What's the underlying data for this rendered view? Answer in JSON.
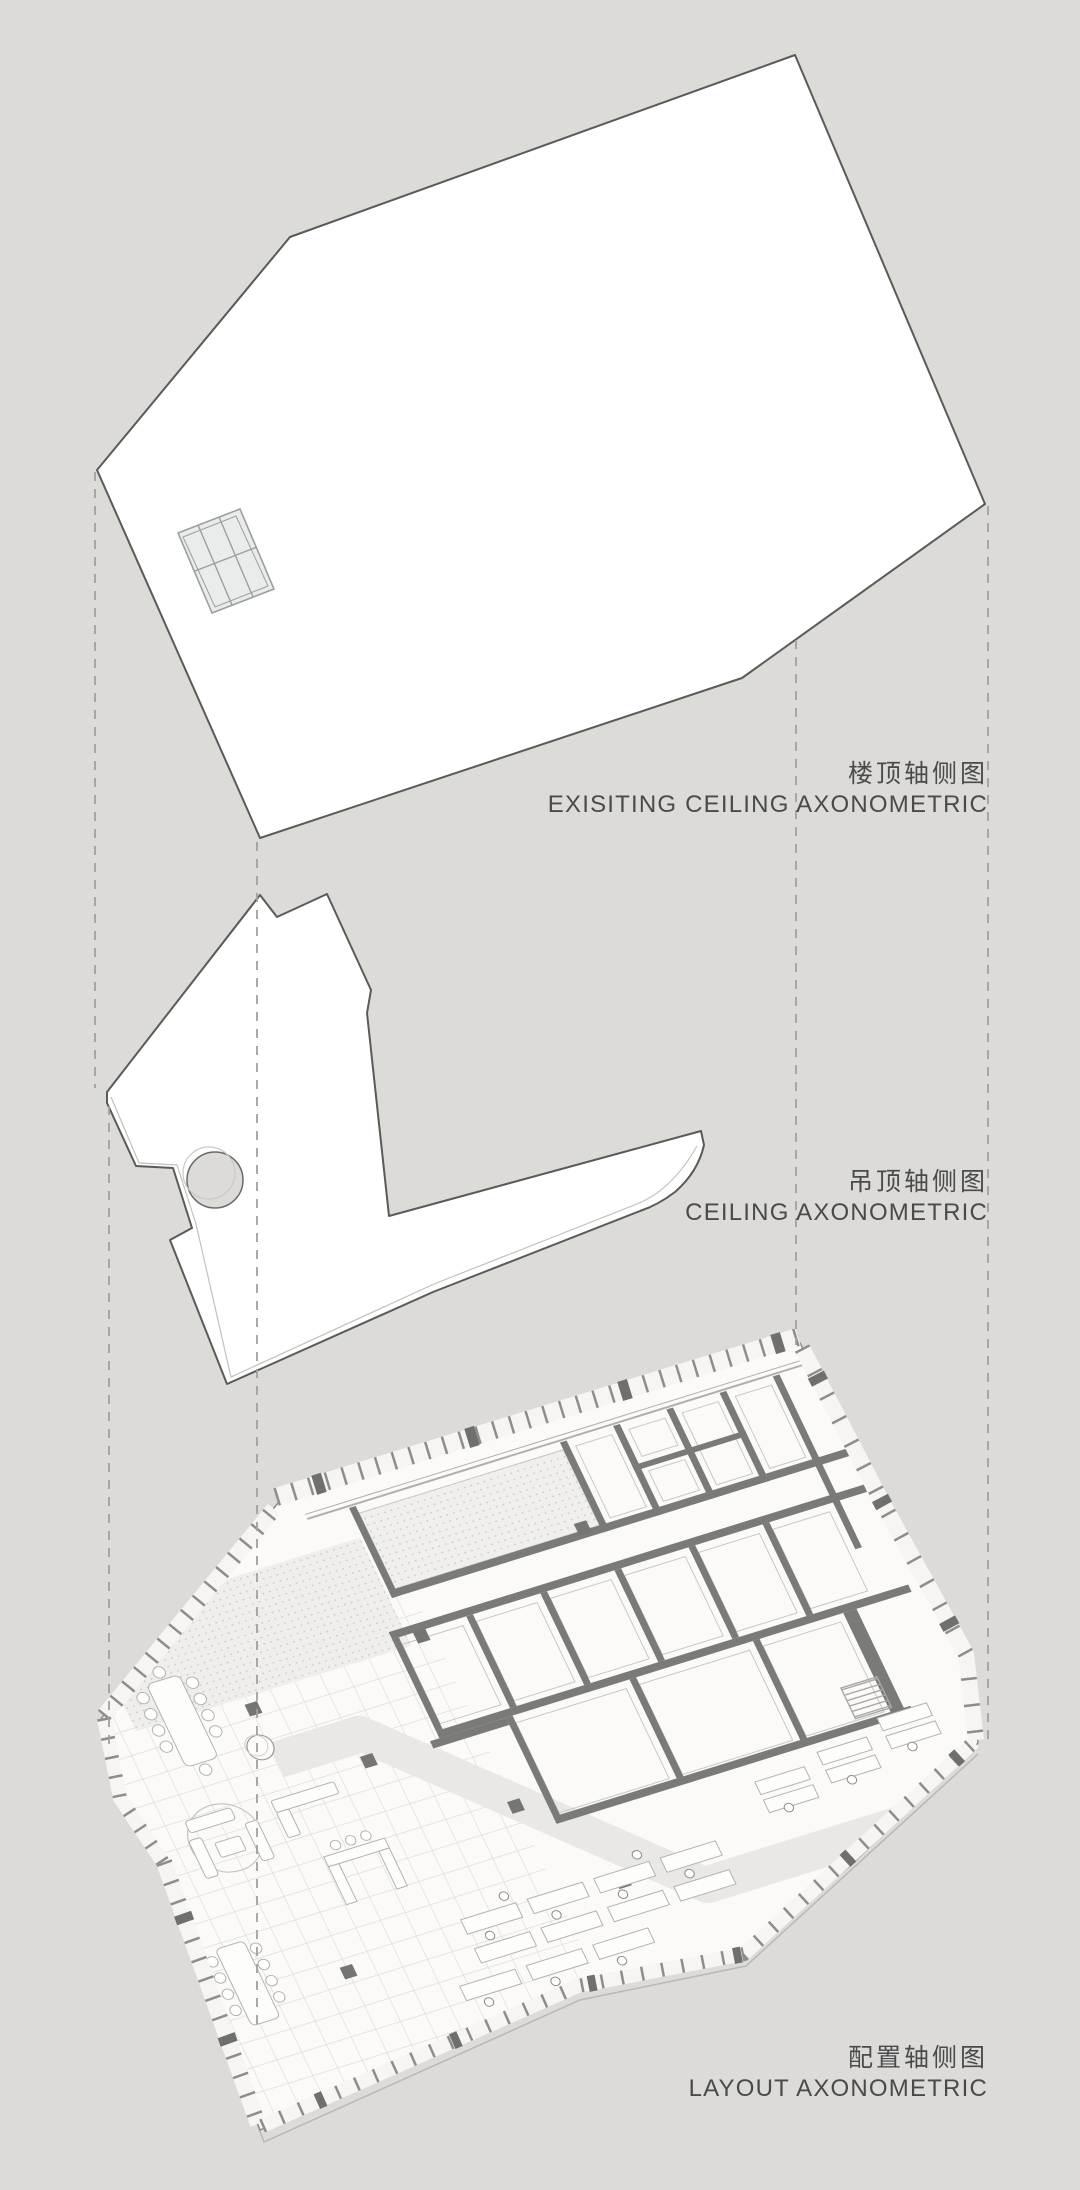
{
  "scene": {
    "background_color": "#dcdbd7",
    "line_color": "#5a5a58",
    "wall_color": "#7a7a78",
    "text_color": "#4a4a4c",
    "guide_color": "#a0a09c",
    "description": "Exploded axonometric diagram with three stacked levels connected by dashed projection lines"
  },
  "views": [
    {
      "id": "existing-ceiling",
      "title_zh": "楼顶轴侧图",
      "title_en": "EXISITING CEILING AXONOMETRIC"
    },
    {
      "id": "ceiling",
      "title_zh": "吊顶轴侧图",
      "title_en": "CEILING AXONOMETRIC"
    },
    {
      "id": "layout",
      "title_zh": "配置轴侧图",
      "title_en": "LAYOUT AXONOMETRIC"
    }
  ]
}
